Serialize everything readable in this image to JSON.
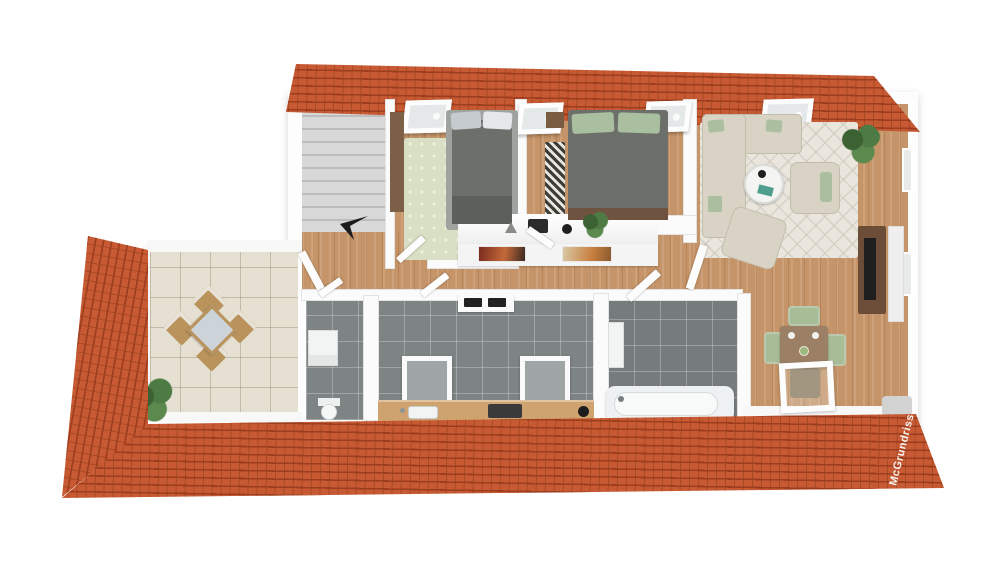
{
  "watermark": {
    "text": "McGrundriss"
  },
  "palette": {
    "roof": "#c75a32",
    "roof_dark": "#9c3e1d",
    "wall": "#fbfbfb",
    "wood": "#c59468",
    "tile": "#7e8484",
    "terrace": "#e5e0d1",
    "stair": "#cccccc",
    "rug_living": "#eae6dd",
    "rug_bed": "#d9dfc4",
    "sofa": "#d8d3c4",
    "bed_dark": "#6d706a",
    "pillow_green": "#a9bfa0",
    "chair_green": "#a8bc98",
    "table_brown": "#9c8066",
    "terrace_chair": "#b9925c",
    "plant": "#4e7a43",
    "plant_dark": "#3c6132",
    "fixture": "#f2f4f4",
    "dark_item": "#2b2b2b"
  },
  "scene": {
    "skylight_count": 4,
    "rooms": [
      "staircase",
      "bedroom-left",
      "bedroom-middle",
      "living-room",
      "hallway",
      "utility-wc",
      "kitchen",
      "bathroom",
      "dining-area",
      "terrace"
    ],
    "furniture": [
      "double-bed",
      "single-bed",
      "corner-sofa",
      "armchair",
      "coffee-table",
      "tv-board",
      "dining-table",
      "dining-chairs",
      "bathtub",
      "toilet",
      "washer-cabinet",
      "kitchen-counter",
      "terrace-dining-set",
      "plants",
      "wall-pictures",
      "hall-sideboard"
    ]
  }
}
